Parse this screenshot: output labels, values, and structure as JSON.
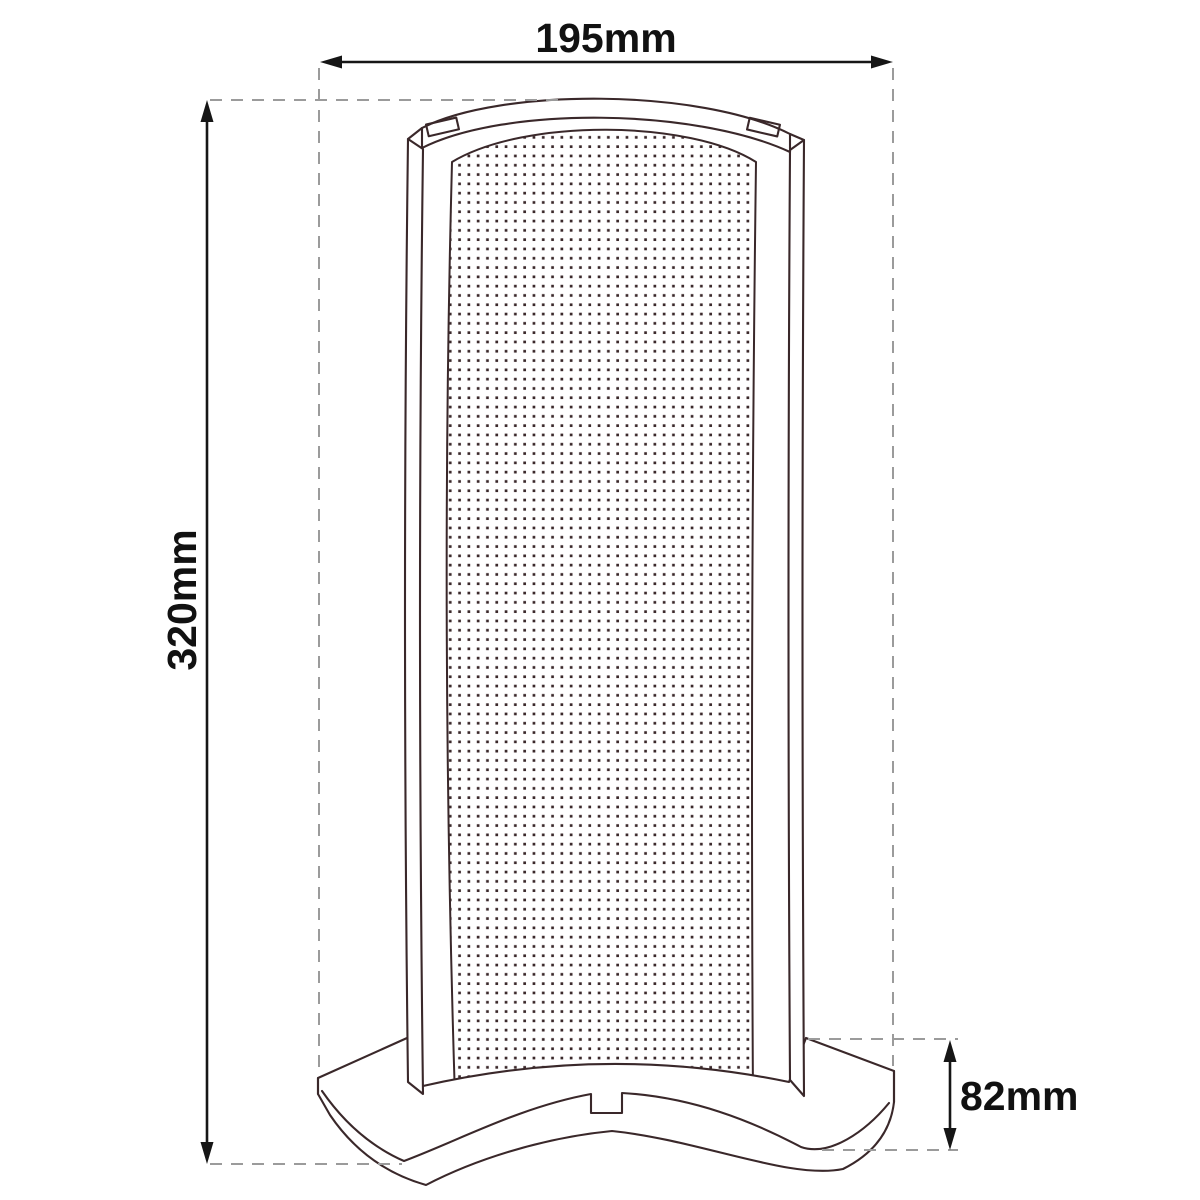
{
  "dimensions": {
    "width_label": "195mm",
    "height_label": "320mm",
    "depth_label": "82mm"
  },
  "colors": {
    "object_line": "#3a282a",
    "dimension_line": "#161616",
    "dimension_text": "#111111",
    "extension_line": "#9b9b9b",
    "background": "#ffffff"
  }
}
